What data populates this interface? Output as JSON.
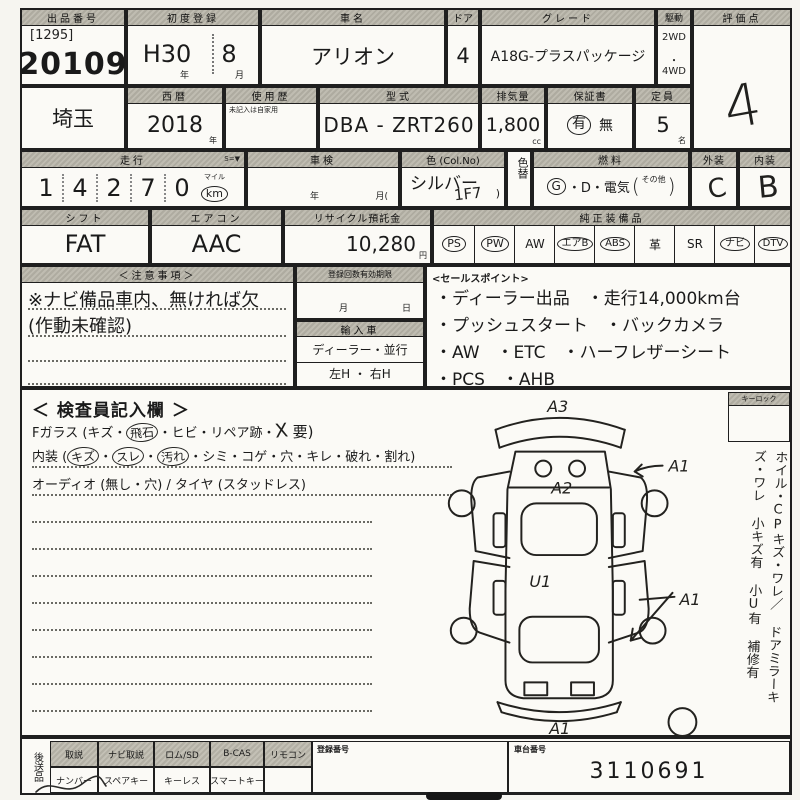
{
  "colors": {
    "ink": "#1f1f1f",
    "paper": "#f6f5f0",
    "header_bg": "#b5b2a8"
  },
  "row1": {
    "auction_no": {
      "label": "出品番号",
      "bracket": "[1295]",
      "value": "20109"
    },
    "first_reg": {
      "label": "初度登録",
      "era": "H30",
      "month": "8",
      "year_suffix": "年",
      "month_suffix": "月"
    },
    "car_name": {
      "label": "車名",
      "value": "アリオン"
    },
    "doors": {
      "label": "ドア",
      "value": "4"
    },
    "grade": {
      "label": "グレード",
      "value": "A18G-プラスパッケージ"
    },
    "drive": {
      "label": "駆動",
      "opt1": "2WD",
      "opt2": "4WD"
    },
    "score": {
      "label": "評価点",
      "value": "4"
    }
  },
  "row2": {
    "prefecture": {
      "value": "埼玉"
    },
    "year": {
      "label": "西暦",
      "value": "2018",
      "suffix": "年"
    },
    "history": {
      "label": "使用歴",
      "note": "未記入は自家用"
    },
    "model": {
      "label": "型式",
      "value": "DBA - ZRT260"
    },
    "displacement": {
      "label": "排気量",
      "value": "1,800",
      "suffix": "cc"
    },
    "warranty": {
      "label": "保証書",
      "yes": "有",
      "no": "無"
    },
    "capacity": {
      "label": "定員",
      "value": "5",
      "suffix": "名"
    }
  },
  "row3": {
    "mileage": {
      "label": "走行",
      "label_right": "S=▼",
      "digits": [
        "1",
        "4",
        "2",
        "7",
        "0"
      ],
      "unit_top": "マイル",
      "unit": "km"
    },
    "inspection": {
      "label": "車検",
      "year": "年",
      "month": "月("
    },
    "color": {
      "label": "色 (Col.No)",
      "value": "シルバー",
      "code": "1F7",
      "paren": ")"
    },
    "color_change": {
      "label": "色替"
    },
    "fuel": {
      "label": "燃料",
      "g": "G",
      "rest": "・D・電気",
      "open": "(",
      "other": "その他",
      "close": ")"
    },
    "exterior": {
      "label": "外装",
      "value": "C"
    },
    "interior": {
      "label": "内装",
      "value": "B"
    }
  },
  "row4": {
    "shift": {
      "label": "シフト",
      "value": "FAT"
    },
    "aircon": {
      "label": "エアコン",
      "value": "AAC"
    },
    "recycle": {
      "label": "リサイクル預託金",
      "value": "10,280",
      "suffix": "円"
    },
    "equipment": {
      "label": "純正装備品",
      "items": [
        {
          "label": "PS",
          "circled": true
        },
        {
          "label": "PW",
          "circled": true
        },
        {
          "label": "AW",
          "circled": false
        },
        {
          "label": "エアB",
          "circled": true
        },
        {
          "label": "ABS",
          "circled": true
        },
        {
          "label": "革",
          "circled": false
        },
        {
          "label": "SR",
          "circled": false
        },
        {
          "label": "ナビ",
          "circled": true
        },
        {
          "label": "DTV",
          "circled": true
        }
      ]
    }
  },
  "notes": {
    "label": "＜注意事項＞",
    "line1": "※ナビ備品車内、無ければ欠",
    "line2": "(作動未確認)",
    "registration": {
      "label": "登録回数有効期限",
      "month": "月",
      "day": "日"
    },
    "import_car": {
      "label": "輸入車",
      "row1": "ディーラー・並行",
      "row2": "左H ・ 右H"
    }
  },
  "sales": {
    "label": "<セールスポイント>",
    "lines": [
      "・ディーラー出品　・走行14,000km台",
      "・プッシュスタート　・バックカメラ",
      "・AW　・ETC　・ハーフレザーシート",
      "・PCS　・AHB"
    ]
  },
  "inspector": {
    "label": "＜ 検査員記入欄 ＞",
    "glass": {
      "prefix": "Fガラス (キズ・",
      "circled": "飛石",
      "mid": "・ヒビ・リペア跡・",
      "mark": "X",
      "suffix": "要)"
    },
    "interior": {
      "prefix": "内装 (",
      "c1": "キズ",
      "sep": "・",
      "c2": "スレ",
      "c3": "汚れ",
      "rest": "・シミ・コゲ・穴・キレ・破れ・割れ)"
    },
    "audio": "オーディオ (無し・穴) / タイヤ (スタッドレス)"
  },
  "diagram": {
    "front": "A3",
    "hood": "A2",
    "front_right": "A1",
    "roof": "U1",
    "rear_right": "A1",
    "rear": "A1"
  },
  "side": {
    "key_lock": "キーロック",
    "notes": [
      "ホイル・CPキズ・ワレ／",
      "ドアミラーキズ・ワレ",
      "小キズ有",
      "小U有",
      "補修有"
    ]
  },
  "bottom": {
    "send_later": "後送品",
    "columns": [
      {
        "top": "取説",
        "bottom": "ナンバー"
      },
      {
        "top": "ナビ取説",
        "bottom": "スペアキー"
      },
      {
        "top": "ロム/SD",
        "bottom": "キーレス"
      },
      {
        "top": "B-CAS",
        "bottom": "スマートキー"
      },
      {
        "top": "リモコン",
        "bottom": ""
      }
    ],
    "reg_no": {
      "label": "登録番号"
    },
    "chassis": {
      "label": "車台番号",
      "value": "3110691"
    }
  }
}
